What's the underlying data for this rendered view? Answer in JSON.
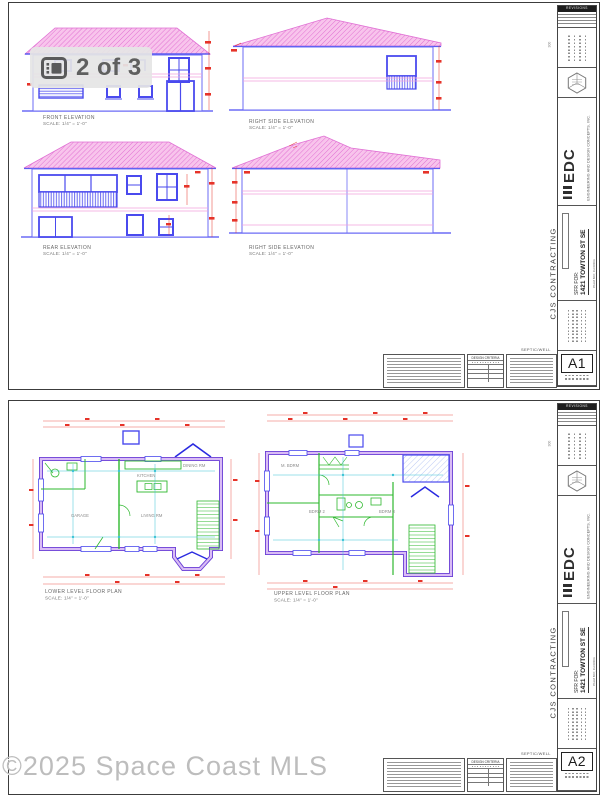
{
  "overlay": {
    "badge_label": "2 of 3",
    "badge_icon": "gallery-icon",
    "watermark": "©2025 Space Coast MLS"
  },
  "title_block": {
    "revisions_header": "REVISIONS",
    "client_vertical": "CJS CONTRACTING",
    "project_label": "SFR FOR:",
    "project_address": "1421 TOWTON ST SE",
    "project_city": "PALM BAY, FLORIDA",
    "firm_abbrev": "EDC",
    "firm_name": "ENGINEERING AND DESIGN CONCEPTS, INC.",
    "seal_icon": "edc-hexagon-seal",
    "septic_label": "SEPTIC/WELL",
    "design_criteria_header": "DESIGN CRITERIA",
    "margin_note": "300"
  },
  "sheet1": {
    "sheet_number": "A1",
    "views": [
      {
        "title": "FRONT ELEVATION",
        "scale": "SCALE: 1/4\" = 1'-0\""
      },
      {
        "title": "RIGHT SIDE ELEVATION",
        "scale": "SCALE: 1/4\" = 1'-0\""
      },
      {
        "title": "REAR ELEVATION",
        "scale": "SCALE: 1/4\" = 1'-0\""
      },
      {
        "title": "RIGHT SIDE ELEVATION",
        "scale": "SCALE: 1/4\" = 1'-0\""
      }
    ]
  },
  "sheet2": {
    "sheet_number": "A2",
    "views": [
      {
        "title": "LOWER LEVEL FLOOR PLAN",
        "scale": "SCALE: 1/4\" = 1'-0\""
      },
      {
        "title": "UPPER LEVEL FLOOR PLAN",
        "scale": "SCALE: 1/4\" = 1'-0\""
      }
    ],
    "rooms_lower": {
      "garage": "GARAGE",
      "living": "LIVING RM",
      "kitchen": "KITCHEN",
      "dining": "DINING RM"
    },
    "rooms_upper": {
      "master": "M. BDRM",
      "bdrm2": "BDRM 2",
      "bdrm3": "BDRM 3"
    }
  },
  "colors": {
    "roof_fill": "#f8c4ec",
    "roof_hatch": "#df68d0",
    "wall_blue": "#5b5bf0",
    "floor_line_pink": "#f2a0dc",
    "dimension_red": "#e63329",
    "plan_wall_purple": "#6a3fd6",
    "plan_wall_light": "#d9bcf5",
    "fixture_green": "#2eb82e",
    "dimension_cyan": "#3cc3d6"
  }
}
